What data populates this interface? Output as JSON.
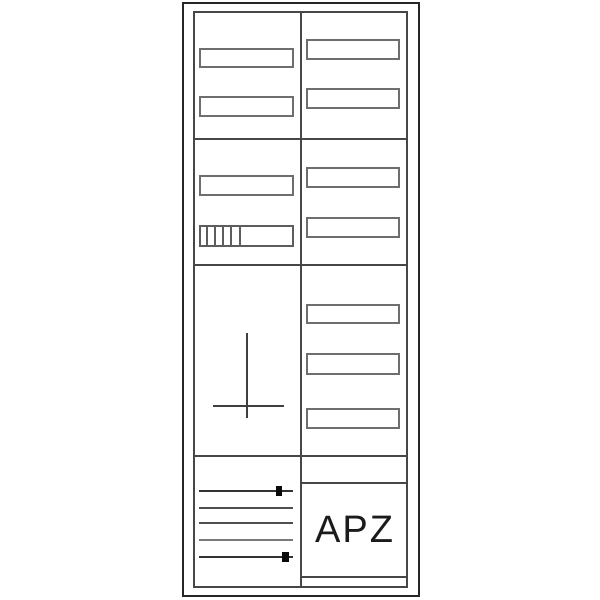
{
  "diagram": {
    "apz_label": "APZ",
    "colors": {
      "background": "#ffffff",
      "outer_frame": "#262626",
      "inner_lines": "#474747",
      "slot_border": "#6e6e6e",
      "cross": "#3f3f3f",
      "marker": "#0a0a0a",
      "text": "#1b1b1b"
    },
    "structure": {
      "columns": 2,
      "sections": 4,
      "left_column_cover_slots": 3,
      "left_column_module_rows": 1,
      "module_row_segments": 5,
      "right_column_cover_slots": 7,
      "terminal_wire_lines": 5,
      "terminal_markers": 2
    },
    "symbols": [
      "meter-mounting-cross-icon",
      "terminal-marker",
      "module-row"
    ]
  }
}
